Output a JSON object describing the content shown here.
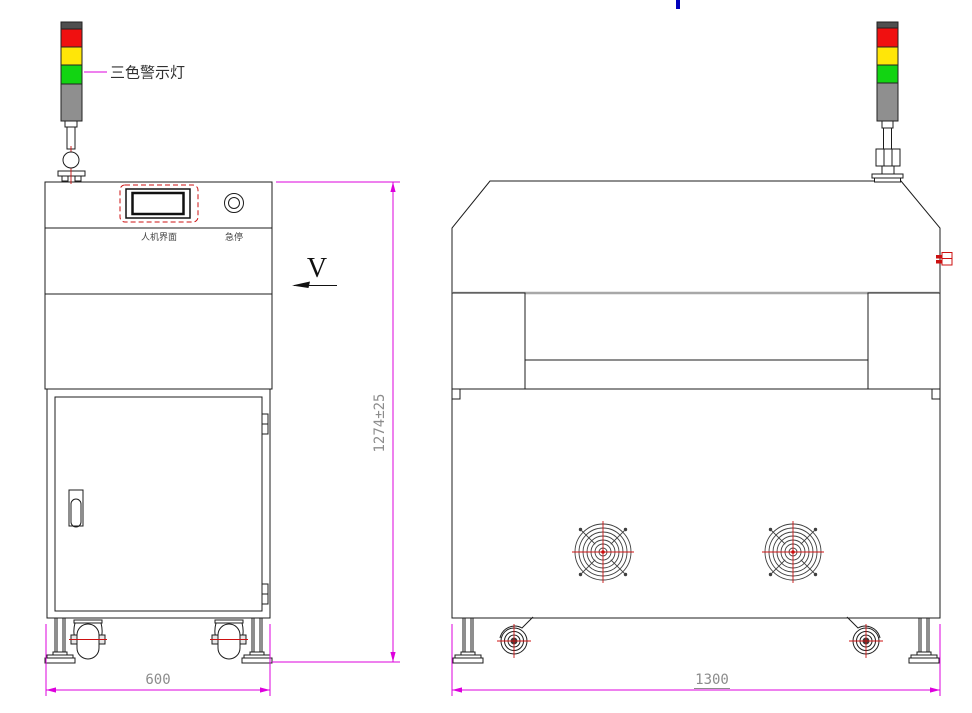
{
  "drawing": {
    "labels": {
      "tower_light": "三色警示灯",
      "hmi": "人机界面",
      "estop": "急停",
      "view_dir": "V"
    },
    "dimensions": {
      "overall_height": "1274±25",
      "side_depth": "600",
      "front_width": "1300"
    },
    "tower_colors": {
      "cap": "#4f4f4f",
      "red": "#f01010",
      "yellow": "#ffe608",
      "green": "#12d412",
      "body": "#8f8f8f"
    },
    "accent_colors": {
      "dimension_magenta": "#dd00dd",
      "centerline_red": "#cc1111",
      "dim_text_gray": "#8c8c8c",
      "outline_black": "#1c1c1c",
      "hood_shadow_gray": "#a8a8a8",
      "top_mark_blue": "#0000bb"
    }
  }
}
